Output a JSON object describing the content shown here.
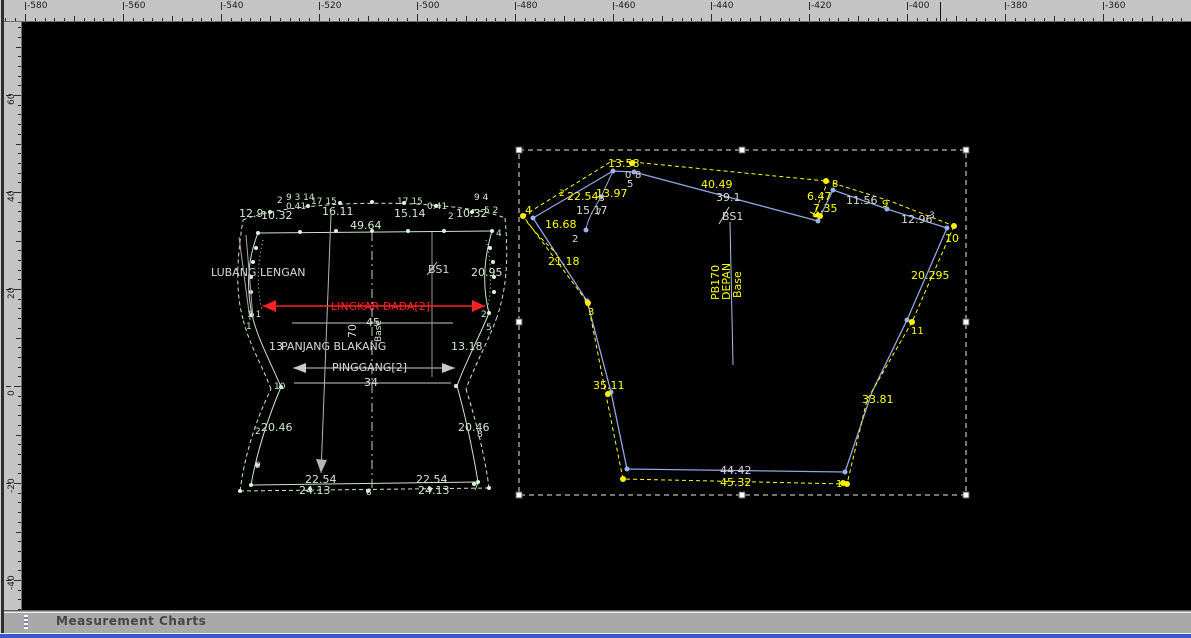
{
  "app": {
    "status_bar_title": "Measurement Charts"
  },
  "colors": {
    "canvas": "#000000",
    "ruler_bg": "#c4c4c4",
    "left_piece": "#cfe3cf",
    "left_white": "#d9d9d9",
    "red": "#ff2222",
    "blue_line": "#8fa6de",
    "yellow": "#ffff00",
    "selection": "#eaeaea",
    "statusbar_bg": "#a9a9a9",
    "bottom_strip": "#3b57c8"
  },
  "rulers": {
    "top": {
      "labels": [
        "-580",
        "-560",
        "-540",
        "-520",
        "-500",
        "-480",
        "-460",
        "-440",
        "-420",
        "-400",
        "-380",
        "-360"
      ],
      "cursor_x": 940
    },
    "left": {
      "labels": [
        "60",
        "40",
        "20",
        "0",
        "-20",
        "-40"
      ]
    }
  },
  "drawing": {
    "groups": [
      {
        "id": "left-piece",
        "c": "#cfe3cf",
        "w": 1,
        "r": 2,
        "dc": "#d8f5d8",
        "pn": "back-pattern-outline",
        "dn": "pattern-point",
        "tc": "#cfe8cf",
        "paths": [
          {
            "d": "M258,233 L492,231"
          },
          {
            "d": "M492,231 C484,258 482,286 489,313"
          },
          {
            "d": "M489,313 C478,340 465,363 457,386"
          },
          {
            "d": "M457,386 C466,418 473,452 478,482"
          },
          {
            "d": "M478,482 L251,485"
          },
          {
            "d": "M251,485 C257,451 268,418 281,387"
          },
          {
            "d": "M281,387 C271,363 258,340 252,315"
          },
          {
            "d": "M252,315 C246,286 248,258 258,233"
          },
          {
            "d": "M263,240 C257,263 257,290 262,310",
            "dash": "1,3"
          },
          {
            "d": "M486,240 C492,263 492,290 487,310",
            "dash": "1,3"
          },
          {
            "d": "M243,220 C292,199 452,197 505,218",
            "dash": "4,3"
          },
          {
            "d": "M505,218 C509,262 506,290 497,317",
            "dash": "4,3"
          },
          {
            "d": "M497,317 C487,344 475,365 466,389",
            "dash": "4,3"
          },
          {
            "d": "M466,389 C476,421 485,456 489,488",
            "dash": "4,3"
          },
          {
            "d": "M489,488 L240,491",
            "dash": "4,3"
          },
          {
            "d": "M240,491 C245,453 256,420 271,389",
            "dash": "4,3"
          },
          {
            "d": "M271,389 C261,363 249,344 243,319",
            "dash": "4,3"
          },
          {
            "d": "M243,319 C235,290 237,258 243,220",
            "dash": "4,3"
          }
        ],
        "dots": [
          [
            258,
            233
          ],
          [
            300,
            232
          ],
          [
            336,
            231
          ],
          [
            372,
            231
          ],
          [
            408,
            231
          ],
          [
            444,
            231
          ],
          [
            492,
            231
          ],
          [
            270,
            212
          ],
          [
            308,
            206
          ],
          [
            340,
            203
          ],
          [
            372,
            202
          ],
          [
            404,
            203
          ],
          [
            436,
            206
          ],
          [
            472,
            212
          ],
          [
            252,
            315
          ],
          [
            489,
            313
          ],
          [
            281,
            387
          ],
          [
            456,
            386
          ],
          [
            251,
            485
          ],
          [
            478,
            482
          ],
          [
            240,
            491
          ],
          [
            489,
            488
          ],
          [
            368,
            491
          ],
          [
            310,
            489
          ],
          [
            430,
            489
          ],
          [
            257,
            465
          ],
          [
            474,
            484
          ],
          [
            256,
            248
          ],
          [
            253,
            262
          ],
          [
            251,
            277
          ],
          [
            251,
            292
          ],
          [
            490,
            248
          ],
          [
            493,
            262
          ],
          [
            494,
            277
          ],
          [
            494,
            292
          ]
        ],
        "labels": [
          {
            "t": "2",
            "x": 277,
            "y": 203,
            "s": 9
          },
          {
            "t": "9 3 14",
            "x": 286,
            "y": 200,
            "s": 9
          },
          {
            "t": "0.41",
            "x": 286,
            "y": 209,
            "s": 9
          },
          {
            "t": "12.9",
            "x": 239,
            "y": 217
          },
          {
            "t": "10.32",
            "x": 261,
            "y": 219
          },
          {
            "t": "16.11",
            "x": 322,
            "y": 215
          },
          {
            "t": "17 15",
            "x": 311,
            "y": 204,
            "s": 9
          },
          {
            "t": "49.64",
            "x": 350,
            "y": 229
          },
          {
            "t": "17 15",
            "x": 397,
            "y": 204,
            "s": 9
          },
          {
            "t": "15.14",
            "x": 394,
            "y": 217
          },
          {
            "t": "0.41",
            "x": 427,
            "y": 209,
            "s": 9
          },
          {
            "t": "2",
            "x": 448,
            "y": 219,
            "s": 9
          },
          {
            "t": "10.32",
            "x": 456,
            "y": 217
          },
          {
            "t": "5 2",
            "x": 484,
            "y": 213,
            "s": 9
          },
          {
            "t": "9 4",
            "x": 474,
            "y": 200,
            "s": 9
          },
          {
            "t": "4",
            "x": 496,
            "y": 236,
            "s": 9
          },
          {
            "t": "LUBANG LENGAN",
            "x": 211,
            "y": 276,
            "c": "#d9d9d9",
            "n": "armhole-label"
          },
          {
            "t": "BS1",
            "x": 428,
            "y": 273,
            "c": "#d9d9d9",
            "n": "bs1-label"
          },
          {
            "t": "20.95",
            "x": 471,
            "y": 276
          },
          {
            "t": "1 1",
            "x": 247,
            "y": 317,
            "s": 9
          },
          {
            "t": "1",
            "x": 246,
            "y": 329,
            "s": 9
          },
          {
            "t": "2",
            "x": 481,
            "y": 317,
            "s": 9
          },
          {
            "t": "5",
            "x": 486,
            "y": 330,
            "s": 9
          },
          {
            "t": "45",
            "x": 366,
            "y": 326
          },
          {
            "t": "70",
            "x": 356,
            "y": 338,
            "r": -90,
            "c": "#d9d9d9"
          },
          {
            "t": "Base",
            "x": 381,
            "y": 342,
            "r": -90,
            "s": 9
          },
          {
            "t": "13",
            "x": 269,
            "y": 350
          },
          {
            "t": "PANJANG BLAKANG",
            "x": 281,
            "y": 350,
            "c": "#d9d9d9",
            "n": "back-length-label"
          },
          {
            "t": "13.18",
            "x": 451,
            "y": 350
          },
          {
            "t": "PINGGANG[2]",
            "x": 332,
            "y": 371,
            "c": "#d9d9d9",
            "n": "waist-label"
          },
          {
            "t": "34",
            "x": 364,
            "y": 386
          },
          {
            "t": "10",
            "x": 274,
            "y": 389,
            "s": 9
          },
          {
            "t": "2",
            "x": 255,
            "y": 434,
            "s": 9
          },
          {
            "t": "20.46",
            "x": 261,
            "y": 431
          },
          {
            "t": "20.46",
            "x": 458,
            "y": 431
          },
          {
            "t": "8",
            "x": 477,
            "y": 437,
            "s": 9
          },
          {
            "t": "9",
            "x": 255,
            "y": 468,
            "s": 9
          },
          {
            "t": "22.54",
            "x": 305,
            "y": 483
          },
          {
            "t": "22.54",
            "x": 416,
            "y": 483
          },
          {
            "t": "24.13",
            "x": 299,
            "y": 494
          },
          {
            "t": "8",
            "x": 366,
            "y": 495,
            "s": 9
          },
          {
            "t": "24.13",
            "x": 418,
            "y": 494
          },
          {
            "t": "7",
            "x": 473,
            "y": 490,
            "s": 9
          }
        ]
      },
      {
        "id": "left-helpers",
        "c": "#c9c9c9",
        "w": 1,
        "pn": "guide-line",
        "paths": [
          {
            "d": "M292,323 L453,323"
          },
          {
            "d": "M294,383 L451,383"
          },
          {
            "d": "M293,368 L455,368"
          },
          {
            "d": "M293,368 L306,363 L306,373 Z",
            "f": 1
          },
          {
            "d": "M455,368 L442,363 L442,373 Z",
            "f": 1
          },
          {
            "d": "M331,214 L321,473",
            "c": "#b5b5b5"
          },
          {
            "d": "M321,473 L316,459 L327,460 Z",
            "f": 1,
            "c": "#b5b5b5"
          },
          {
            "d": "M372,232 L372,492",
            "dash": "9,4,2,4"
          },
          {
            "d": "M432,232 L432,377",
            "c": "#999999"
          },
          {
            "d": "M427,275 L437,262"
          },
          {
            "d": "M239,237 L250,320",
            "c": "#aaaaaa"
          },
          {
            "d": "M246,235 L253,318",
            "c": "#aaaaaa"
          }
        ]
      },
      {
        "id": "chest-measure",
        "c": "#ff2222",
        "w": 1.5,
        "pn": "chest-arrow",
        "paths": [
          {
            "d": "M263,306 L485,306"
          },
          {
            "d": "M263,306 L276,300 L276,312 Z",
            "f": 1
          },
          {
            "d": "M485,306 L472,300 L472,312 Z",
            "f": 1
          }
        ],
        "labels": [
          {
            "t": "LINGKAR DADA[2]",
            "x": 331,
            "y": 310,
            "c": "#ff2222",
            "n": "chest-girth-label"
          }
        ]
      },
      {
        "id": "right-piece-blue",
        "c": "#8fa6de",
        "w": 1.3,
        "r": 2.5,
        "dc": "#9ab4ea",
        "pn": "front-pattern-outline",
        "dn": "pattern-point",
        "paths": [
          {
            "d": "M533,218 L613,171"
          },
          {
            "d": "M613,171 L634,172"
          },
          {
            "d": "M634,172 L818,221"
          },
          {
            "d": "M818,221 L833,190"
          },
          {
            "d": "M833,190 L887,209 L947,228"
          },
          {
            "d": "M947,228 L907,320 L872,392 L845,472"
          },
          {
            "d": "M845,472 L627,469"
          },
          {
            "d": "M627,469 L611,392 L587,301 L533,218"
          },
          {
            "d": "M613,171 L601,197",
            "w": 1
          },
          {
            "d": "M601,197 C592,212 587,221 586,230",
            "w": 1
          },
          {
            "d": "M730,222 L733,365",
            "c": "#a9bce8",
            "w": 1
          },
          {
            "d": "M719,224 L729,207",
            "c": "#cfcfcf",
            "w": 1
          }
        ],
        "dots": [
          [
            533,
            218
          ],
          [
            613,
            171
          ],
          [
            634,
            172
          ],
          [
            818,
            221
          ],
          [
            833,
            190
          ],
          [
            887,
            209
          ],
          [
            947,
            228
          ],
          [
            907,
            320
          ],
          [
            845,
            472
          ],
          [
            627,
            469
          ],
          [
            611,
            392
          ],
          [
            587,
            301
          ],
          [
            601,
            197
          ],
          [
            586,
            230
          ]
        ]
      },
      {
        "id": "right-piece-yellow",
        "c": "#ffff00",
        "w": 1,
        "r": 3,
        "dc": "#ffee00",
        "pn": "seam-allowance-line",
        "dn": "seam-point",
        "tc": "#ffff00",
        "paths": [
          {
            "d": "M523,216 L612,161 L633,162",
            "dash": "4,3"
          },
          {
            "d": "M633,162 L826,181",
            "dash": "4,3"
          },
          {
            "d": "M826,181 L890,201 L954,226",
            "dash": "4,3"
          },
          {
            "d": "M813,216 L827,184",
            "dash": "4,3"
          },
          {
            "d": "M954,226 L912,322 L867,400 L847,484",
            "dash": "4,3"
          },
          {
            "d": "M847,484 L623,479",
            "dash": "4,3"
          },
          {
            "d": "M623,479 L605,390 L588,303 L523,216",
            "dash": "4,3"
          },
          {
            "d": "M527,222 C538,236 549,246 557,254",
            "dash": "4,3"
          },
          {
            "d": "M810,212 L822,218"
          },
          {
            "d": "M822,218 L813,217 L818,211 Z",
            "f": 1
          }
        ],
        "dots": [
          [
            523,
            216
          ],
          [
            632,
            163
          ],
          [
            826,
            181
          ],
          [
            954,
            226
          ],
          [
            912,
            322
          ],
          [
            847,
            484
          ],
          [
            623,
            479
          ],
          [
            588,
            303
          ],
          [
            608,
            394
          ],
          [
            820,
            216
          ],
          [
            843,
            483
          ]
        ],
        "labels": [
          {
            "t": "4",
            "x": 525,
            "y": 214
          },
          {
            "t": "2",
            "x": 559,
            "y": 196,
            "s": 9
          },
          {
            "t": "22.54",
            "x": 567,
            "y": 200
          },
          {
            "t": "13.97",
            "x": 596,
            "y": 197
          },
          {
            "t": "16.68",
            "x": 545,
            "y": 228
          },
          {
            "t": "13.58",
            "x": 608,
            "y": 167
          },
          {
            "t": "40.49",
            "x": 701,
            "y": 188
          },
          {
            "t": "6.47",
            "x": 807,
            "y": 200
          },
          {
            "t": "7.35",
            "x": 813,
            "y": 212
          },
          {
            "t": "8",
            "x": 832,
            "y": 187,
            "s": 10
          },
          {
            "t": "9",
            "x": 882,
            "y": 207,
            "s": 10
          },
          {
            "t": "10",
            "x": 945,
            "y": 242
          },
          {
            "t": "20.295",
            "x": 911,
            "y": 279
          },
          {
            "t": "11",
            "x": 911,
            "y": 334,
            "s": 10
          },
          {
            "t": "33.81",
            "x": 862,
            "y": 403
          },
          {
            "t": "35.11",
            "x": 593,
            "y": 389
          },
          {
            "t": "21.18",
            "x": 548,
            "y": 265
          },
          {
            "t": "3",
            "x": 588,
            "y": 315,
            "s": 10
          },
          {
            "t": "45.32",
            "x": 720,
            "y": 486
          },
          {
            "t": "1",
            "x": 836,
            "y": 487,
            "s": 10
          },
          {
            "t": "PB170",
            "x": 719,
            "y": 300,
            "r": -90,
            "n": "piece-name-label"
          },
          {
            "t": "DEPAN",
            "x": 730,
            "y": 300,
            "r": -90,
            "n": "piece-name-label"
          },
          {
            "t": "Base",
            "x": 741,
            "y": 298,
            "r": -90,
            "n": "piece-name-label"
          }
        ]
      },
      {
        "id": "right-piece-white-text",
        "c": "#d9d9d9",
        "tc": "#d9d9d9",
        "labels": [
          {
            "t": "15.17",
            "x": 576,
            "y": 214
          },
          {
            "t": "2",
            "x": 572,
            "y": 242,
            "s": 10
          },
          {
            "t": "0",
            "x": 625,
            "y": 178,
            "s": 10
          },
          {
            "t": "8",
            "x": 635,
            "y": 178,
            "s": 10
          },
          {
            "t": "5",
            "x": 627,
            "y": 187,
            "s": 10
          },
          {
            "t": "3",
            "x": 599,
            "y": 201,
            "s": 9
          },
          {
            "t": "7",
            "x": 596,
            "y": 215,
            "s": 9
          },
          {
            "t": "39.1",
            "x": 716,
            "y": 201
          },
          {
            "t": "11.56",
            "x": 846,
            "y": 204
          },
          {
            "t": "12.96",
            "x": 901,
            "y": 223
          },
          {
            "t": "3",
            "x": 929,
            "y": 218,
            "s": 9
          },
          {
            "t": "BS1",
            "x": 722,
            "y": 220,
            "n": "bs1-label"
          },
          {
            "t": "44.42",
            "x": 720,
            "y": 474
          }
        ]
      },
      {
        "id": "selection",
        "c": "#eaeaea",
        "w": 1,
        "pn": "selection-marquee",
        "paths": [
          {
            "d": "M519,150 L966,150 L966,495 L519,495 Z",
            "dash": "5,4"
          }
        ]
      }
    ],
    "selection_handles": [
      [
        519,
        150
      ],
      [
        742,
        150
      ],
      [
        966,
        150
      ],
      [
        519,
        322
      ],
      [
        966,
        322
      ],
      [
        519,
        495
      ],
      [
        742,
        495
      ],
      [
        966,
        495
      ]
    ]
  }
}
